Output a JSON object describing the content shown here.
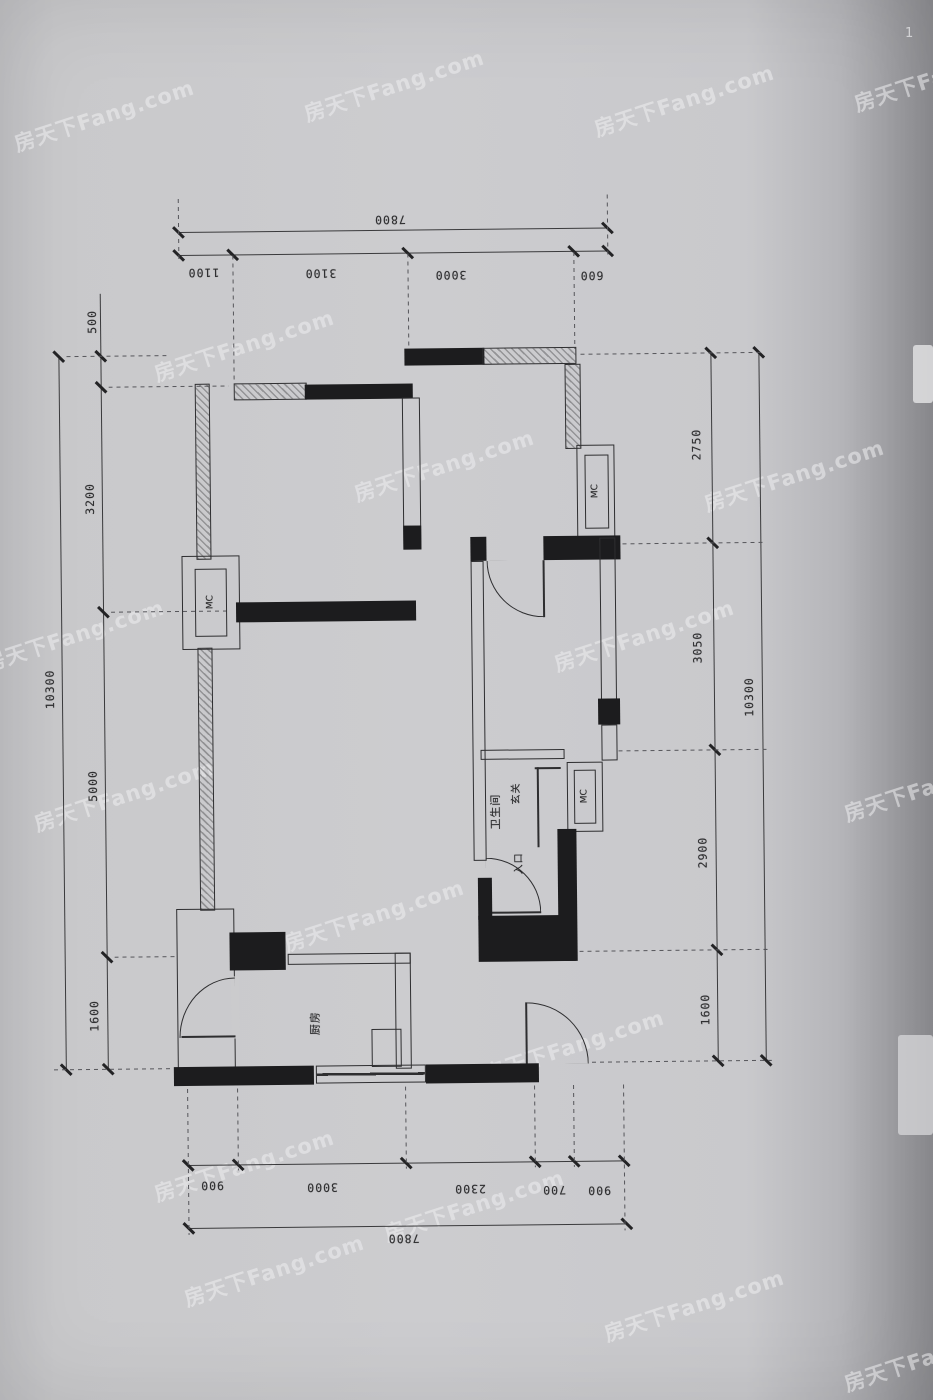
{
  "watermark": {
    "text": "房天下Fang.com"
  },
  "artifacts": {
    "corner_mark": "1"
  },
  "plan": {
    "rooms": {
      "bathroom": "卫生间",
      "kitchen": "厨房",
      "foyer": "玄关",
      "entrance": "入口"
    },
    "fixture_label": "MC",
    "dims": {
      "top": {
        "overall": "7800",
        "segments": [
          "1100",
          "3100",
          "3000",
          "600"
        ]
      },
      "bottom": {
        "overall": "7800",
        "segments": [
          "900",
          "3000",
          "2300",
          "700",
          "900"
        ]
      },
      "left": {
        "overall": "10300",
        "segments": [
          "500",
          "3200",
          "5000",
          "1600"
        ]
      },
      "right": {
        "overall": "10300",
        "segments": [
          "2750",
          "3050",
          "2900",
          "1600"
        ]
      }
    }
  },
  "colors": {
    "paper": "#c9c9cb",
    "ink": "#2e2e30",
    "wall_fill": "#1c1c1e",
    "watermark": "rgba(238,238,241,0.55)"
  }
}
